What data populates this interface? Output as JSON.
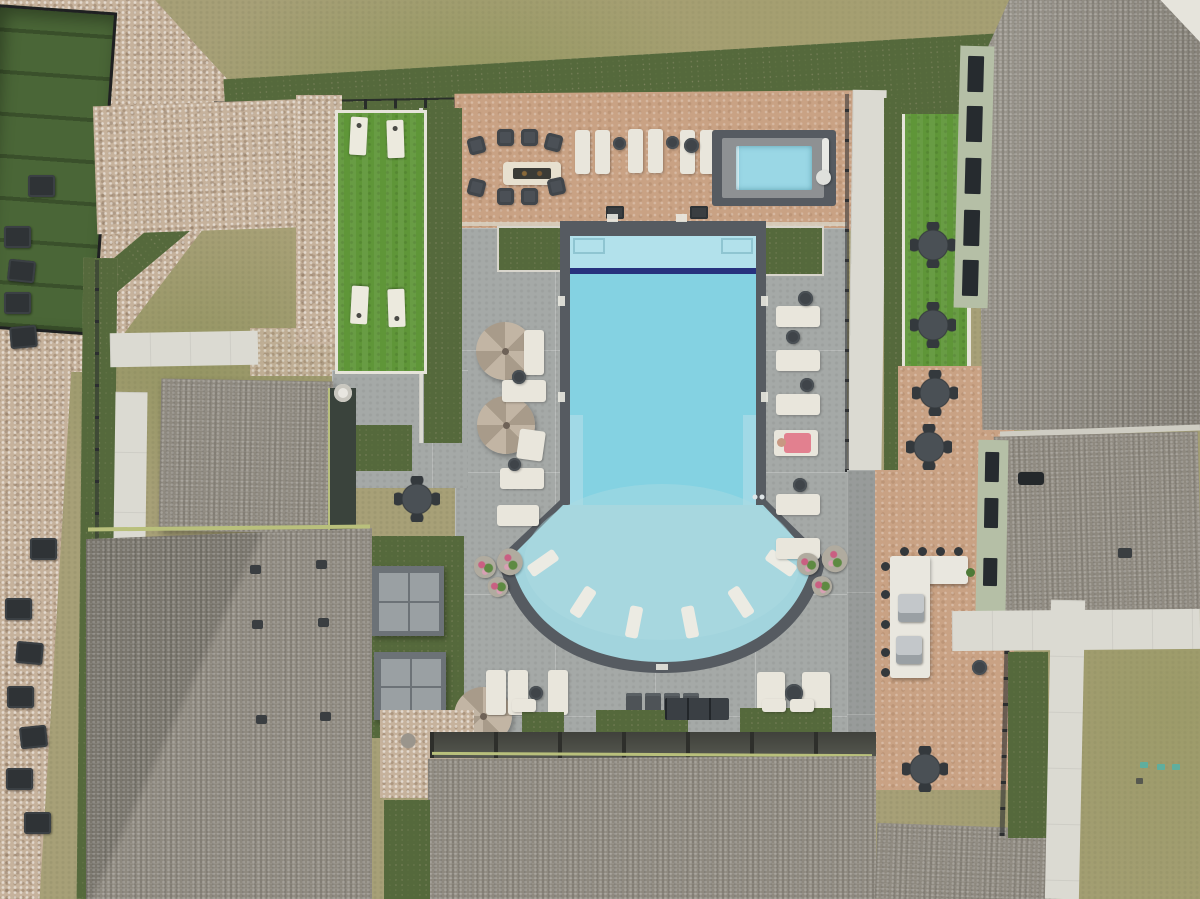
{
  "scene": {
    "type": "aerial-drone-photograph",
    "subject": "apartment community pool courtyard viewed from directly overhead",
    "visible_text": "none",
    "elements": {
      "main_pool": {
        "shape": "rectangle with curved fan tanning shelf at south end",
        "lap_lane_tile": "navy",
        "in_pool_loungers": 6
      },
      "spa": {
        "shape": "rectangular hot tub",
        "ada_lift": true
      },
      "cornhole_boards": 4,
      "fire_pit_chairs": 8,
      "umbrellas": 3,
      "cabanas": 2,
      "grills": 2,
      "dining_table_sets": 6,
      "benches": 4,
      "planters_with_flowers": 6,
      "hvac_units": 12,
      "person": {
        "location": "east poolside lounger",
        "towel_color": "pink"
      }
    }
  },
  "palette": {
    "dry_grass": "#a7a077",
    "gravel": "#c6b29c",
    "turf_green": "#5f9638",
    "pool_deck_gray": "#a5a9a7",
    "pool_deck_tan": "#c9a284",
    "sidewalk": "#dbdad2",
    "pool_coping": "#565b61",
    "pool_water": "#84d2e2",
    "pool_shelf": "#b2e1eb",
    "pool_fan_shallow": "#a2d4dd",
    "lap_lane_tile": "#27327d",
    "spa_water": "#9ad7e5",
    "roof_shingle": "#8e897f",
    "roof_trim": "#b9c07c",
    "fence": "#2c2e30",
    "furniture_white": "#e9e6dc",
    "furniture_dark": "#4b5056",
    "umbrella_tan": "#b5a897",
    "fire_table": "#e7e0cf",
    "towel_pink": "#e2808f"
  }
}
